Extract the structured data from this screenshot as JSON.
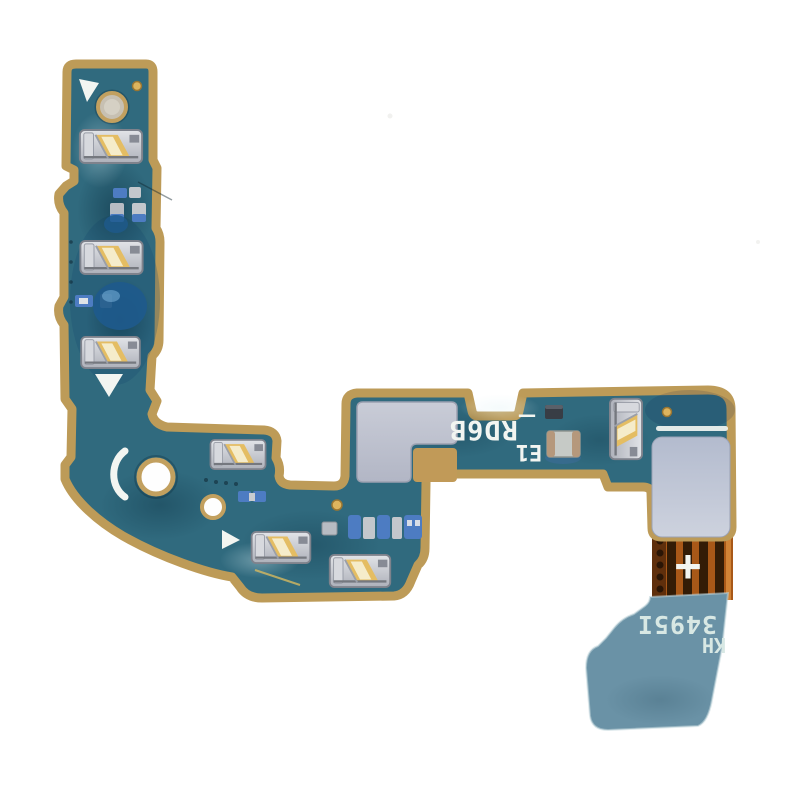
{
  "photo": {
    "subject": "Flex cable PCB replacement part photographed on a white background",
    "background": "#ffffff"
  },
  "board_markings": {
    "arm_code": "_RD6B",
    "arm_rev": "E1",
    "tail_serial": "3495I",
    "tail_code": "KH",
    "polarity_mark": "+"
  },
  "colors": {
    "solder_mask": "#306a7e",
    "board_edge": "#bd9b58",
    "substrate_tan": "#c19a58",
    "ribbon_copper": "#a85818",
    "ribbon_dark": "#331c06",
    "ribbon_edge": "#5f2f0c",
    "ribbon_highlight": "#d18336",
    "tail_blue": "#6a92a6",
    "shield_gray": "#c0c4d0",
    "sticker_gray": "#bcc3d4",
    "contact_silver": "#c7c9d0",
    "contact_gold": "#e4bd63",
    "glue_blue": "#4d7cc2",
    "glue_dark": "#1e5a8c",
    "silkscreen": "#f2f5f1",
    "tail_text": "#d8e8e4",
    "hole_ring": "#c2a05f",
    "fiducial": "#ddb45e"
  },
  "parts": {
    "spring_contacts": 7,
    "mounting_holes": 2,
    "microphone_hole": 1,
    "shield_pads": 2,
    "fiducials": 3,
    "silkscreen_triangles": 3
  }
}
